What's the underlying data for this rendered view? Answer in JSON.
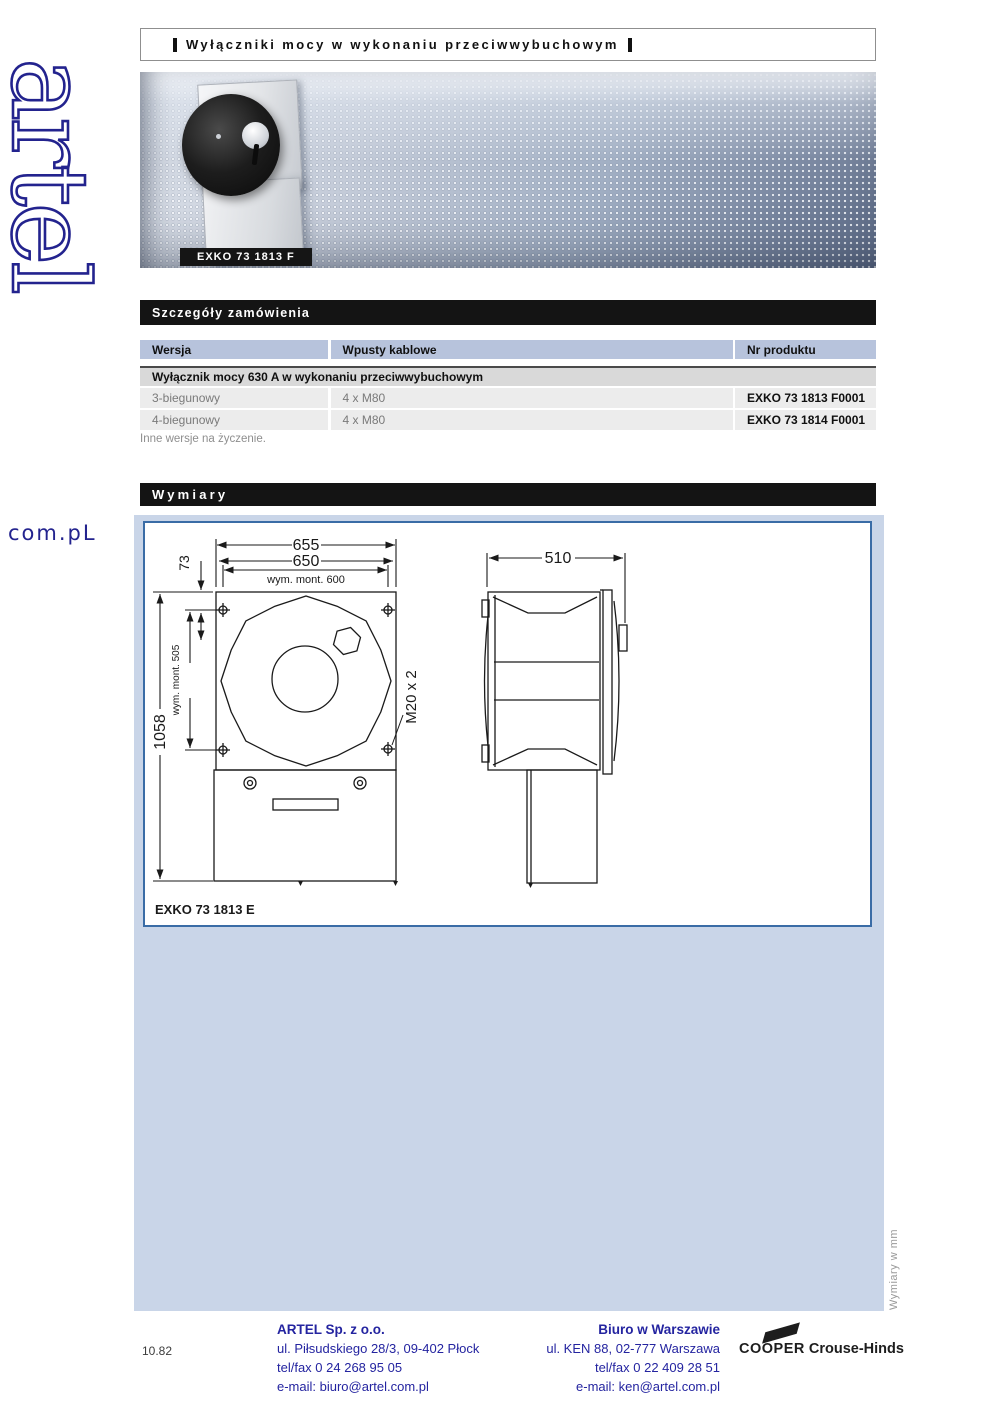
{
  "page": {
    "title": "Wyłączniki mocy w wykonaniu przeciwwybuchowym",
    "page_number": "10.82",
    "side_note": "Wymiary w mm"
  },
  "logo": {
    "brand": "artel",
    "domain": "com.pL"
  },
  "hero": {
    "product_label": "EXKO 73 1813 F"
  },
  "order": {
    "section_title": "Szczegóły zamówienia",
    "columns": [
      "Wersja",
      "Wpusty kablowe",
      "Nr produktu"
    ],
    "group_header": "Wyłącznik mocy 630 A w wykonaniu przeciwwybuchowym",
    "rows": [
      {
        "version": "3-biegunowy",
        "glands": "4 x M80",
        "product_no": "EXKO 73 1813 F0001"
      },
      {
        "version": "4-biegunowy",
        "glands": "4 x M80",
        "product_no": "EXKO 73 1814 F0001"
      }
    ],
    "footnote": "Inne wersje na życzenie."
  },
  "dimensions": {
    "section_title": "Wymiary",
    "drawing_label": "EXKO 73 1813 E",
    "width_overall": "655",
    "width_cover": "650",
    "width_mount": "wym. mont. 600",
    "top_offset": "73",
    "height_overall": "1058",
    "height_mount": "wym. mont. 505",
    "thread": "M20 x 2",
    "depth": "510"
  },
  "footer": {
    "company": {
      "name": "ARTEL Sp. z o.o.",
      "address": "ul. Piłsudskiego 28/3, 09-402 Płock",
      "telfax": "tel/fax 0 24 268 95 05",
      "email": "e-mail: biuro@artel.com.pl"
    },
    "office": {
      "name": "Biuro w Warszawie",
      "address": "ul. KEN 88, 02-777 Warszawa",
      "telfax": "tel/fax 0 22 409 28 51",
      "email": "e-mail: ken@artel.com.pl"
    },
    "brand": {
      "primary": "COOPER",
      "secondary": "Crouse-Hinds"
    }
  },
  "colors": {
    "accent_navy": "#23238e",
    "table_header_bg": "#b7c3dc",
    "section_bar_bg": "#141414",
    "blue_panel_bg": "#c9d5e8",
    "drawing_border": "#3a6ca6"
  }
}
